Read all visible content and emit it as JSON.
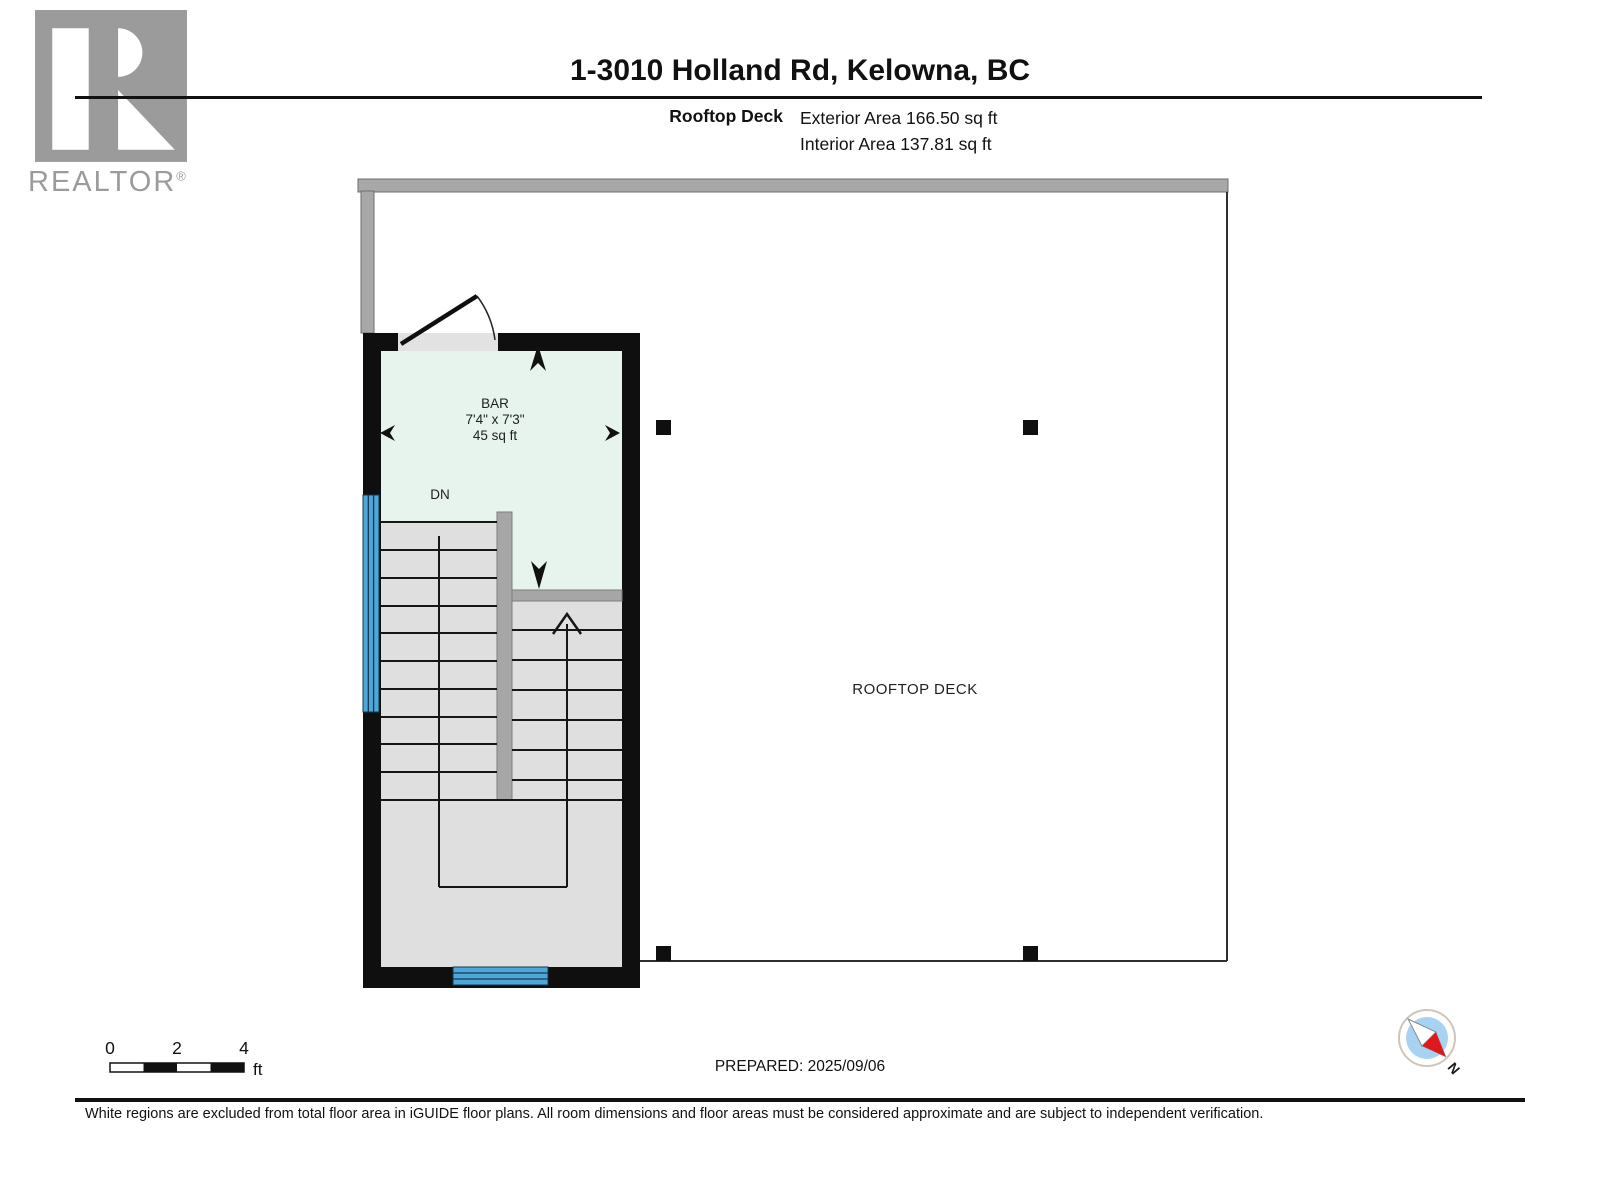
{
  "logo": {
    "brand": "REALTOR",
    "registered": "®"
  },
  "header": {
    "title": "1-3010 Holland Rd, Kelowna, BC",
    "floor_label": "Rooftop Deck",
    "exterior_area": "Exterior Area 166.50 sq ft",
    "interior_area": "Interior Area 137.81 sq ft"
  },
  "plan": {
    "deck_label": "ROOFTOP DECK",
    "stair_label": "DN",
    "room": {
      "name": "BAR",
      "dimensions": "7'4\" x 7'3\"",
      "area": "45 sq ft"
    }
  },
  "scale_bar": {
    "ticks": [
      "0",
      "2",
      "4"
    ],
    "unit": "ft"
  },
  "footer": {
    "prepared": "PREPARED: 2025/09/06",
    "disclaimer": "White regions are excluded from total floor area in iGUIDE floor plans. All room dimensions and floor areas must be considered approximate and are subject to independent verification.",
    "compass_north": "N"
  },
  "colors": {
    "wall": "#0f0f0f",
    "room_fill": "#e7f3ed",
    "stair_fill": "#e0e0e0",
    "interior_wall_gray": "#a6a6a6",
    "deck_rail_gray": "#a8a8a8",
    "window_blue": "#4da7d9",
    "compass_red": "#e0181c",
    "compass_blue": "#a7d2f1",
    "logo_gray": "#9b9b9b"
  }
}
